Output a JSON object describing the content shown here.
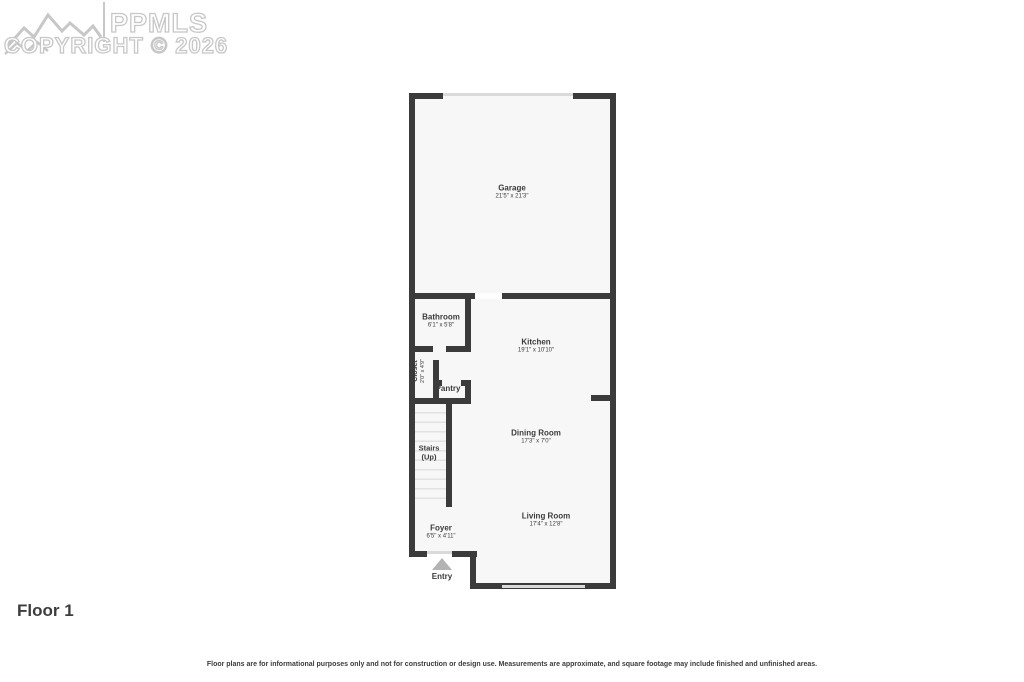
{
  "watermark": {
    "brand": "PPMLS",
    "copyright": "COPYRIGHT © 2026",
    "logo_icon": "mountains-icon",
    "color": "#c7c7c7"
  },
  "floor_label": "Floor 1",
  "disclaimer": "Floor plans are for informational purposes only and not for construction or design use. Measurements are approximate, and square footage may include finished and unfinished areas.",
  "rooms": {
    "garage": {
      "name": "Garage",
      "dims": "21'5\" x 21'3\""
    },
    "bathroom": {
      "name": "Bathroom",
      "dims": "6'1\" x 5'8\""
    },
    "kitchen": {
      "name": "Kitchen",
      "dims": "19'1\" x 10'10\""
    },
    "closet": {
      "name": "Closet",
      "dims": "2'0\" x 4'9\""
    },
    "pantry": {
      "name": "Pantry"
    },
    "stairs": {
      "name": "Stairs",
      "dims": "(Up)"
    },
    "dining_room": {
      "name": "Dining Room",
      "dims": "17'3\" x 7'0\""
    },
    "living_room": {
      "name": "Living Room",
      "dims": "17'4\" x 12'8\""
    },
    "foyer": {
      "name": "Foyer",
      "dims": "6'5\" x 4'11\""
    },
    "entry": {
      "name": "Entry"
    }
  },
  "colors": {
    "wall": "#3b3b3b",
    "floor_fill": "#f7f7f7",
    "step_line": "#e2e2e2",
    "door_opening": "#dadada",
    "window": "#d9d9d9",
    "entry_arrow": "#b3b3b3",
    "text": "#3b3b3b",
    "watermark": "#c7c7c7"
  }
}
